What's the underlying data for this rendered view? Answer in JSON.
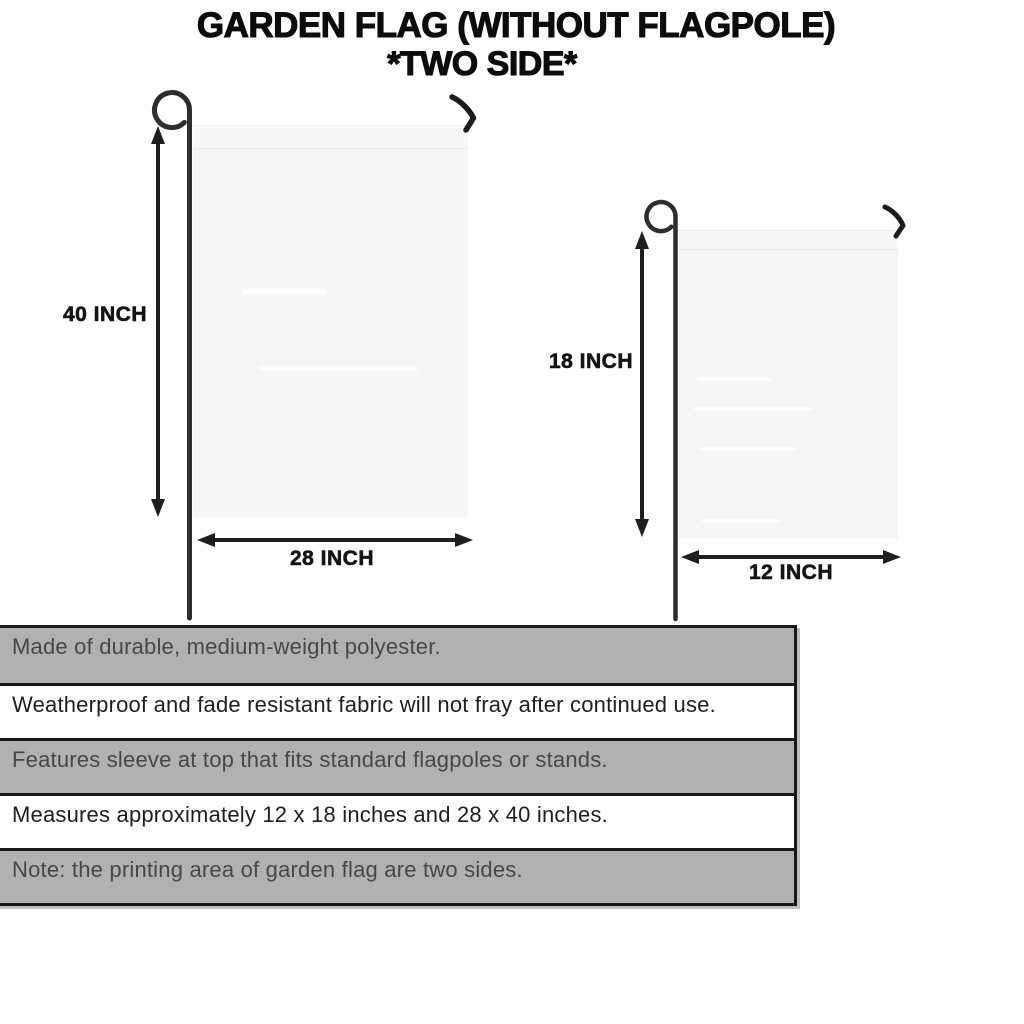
{
  "title": {
    "line1": "GARDEN FLAG (WITHOUT FLAGPOLE)",
    "line2": "*TWO SIDE*"
  },
  "diagram": {
    "large_flag": {
      "height_label": "40 INCH",
      "width_label": "28 INCH"
    },
    "small_flag": {
      "height_label": "18 INCH",
      "width_label": "12 INCH"
    }
  },
  "specs": [
    {
      "text": "Made of durable, medium-weight polyester."
    },
    {
      "text": "Weatherproof and fade resistant fabric will not fray after continued use."
    },
    {
      "text": "Features sleeve at top that fits standard flagpoles or stands."
    },
    {
      "text": "Measures approximately 12 x 18 inches and 28 x 40 inches."
    },
    {
      "text": "Note: the printing area of garden flag are two sides."
    }
  ],
  "colors": {
    "shade-row": "#b1b1b1",
    "flag-fill": "#f6f6f7",
    "line": "#1e1e1e",
    "pole": "#2d2d2b"
  }
}
